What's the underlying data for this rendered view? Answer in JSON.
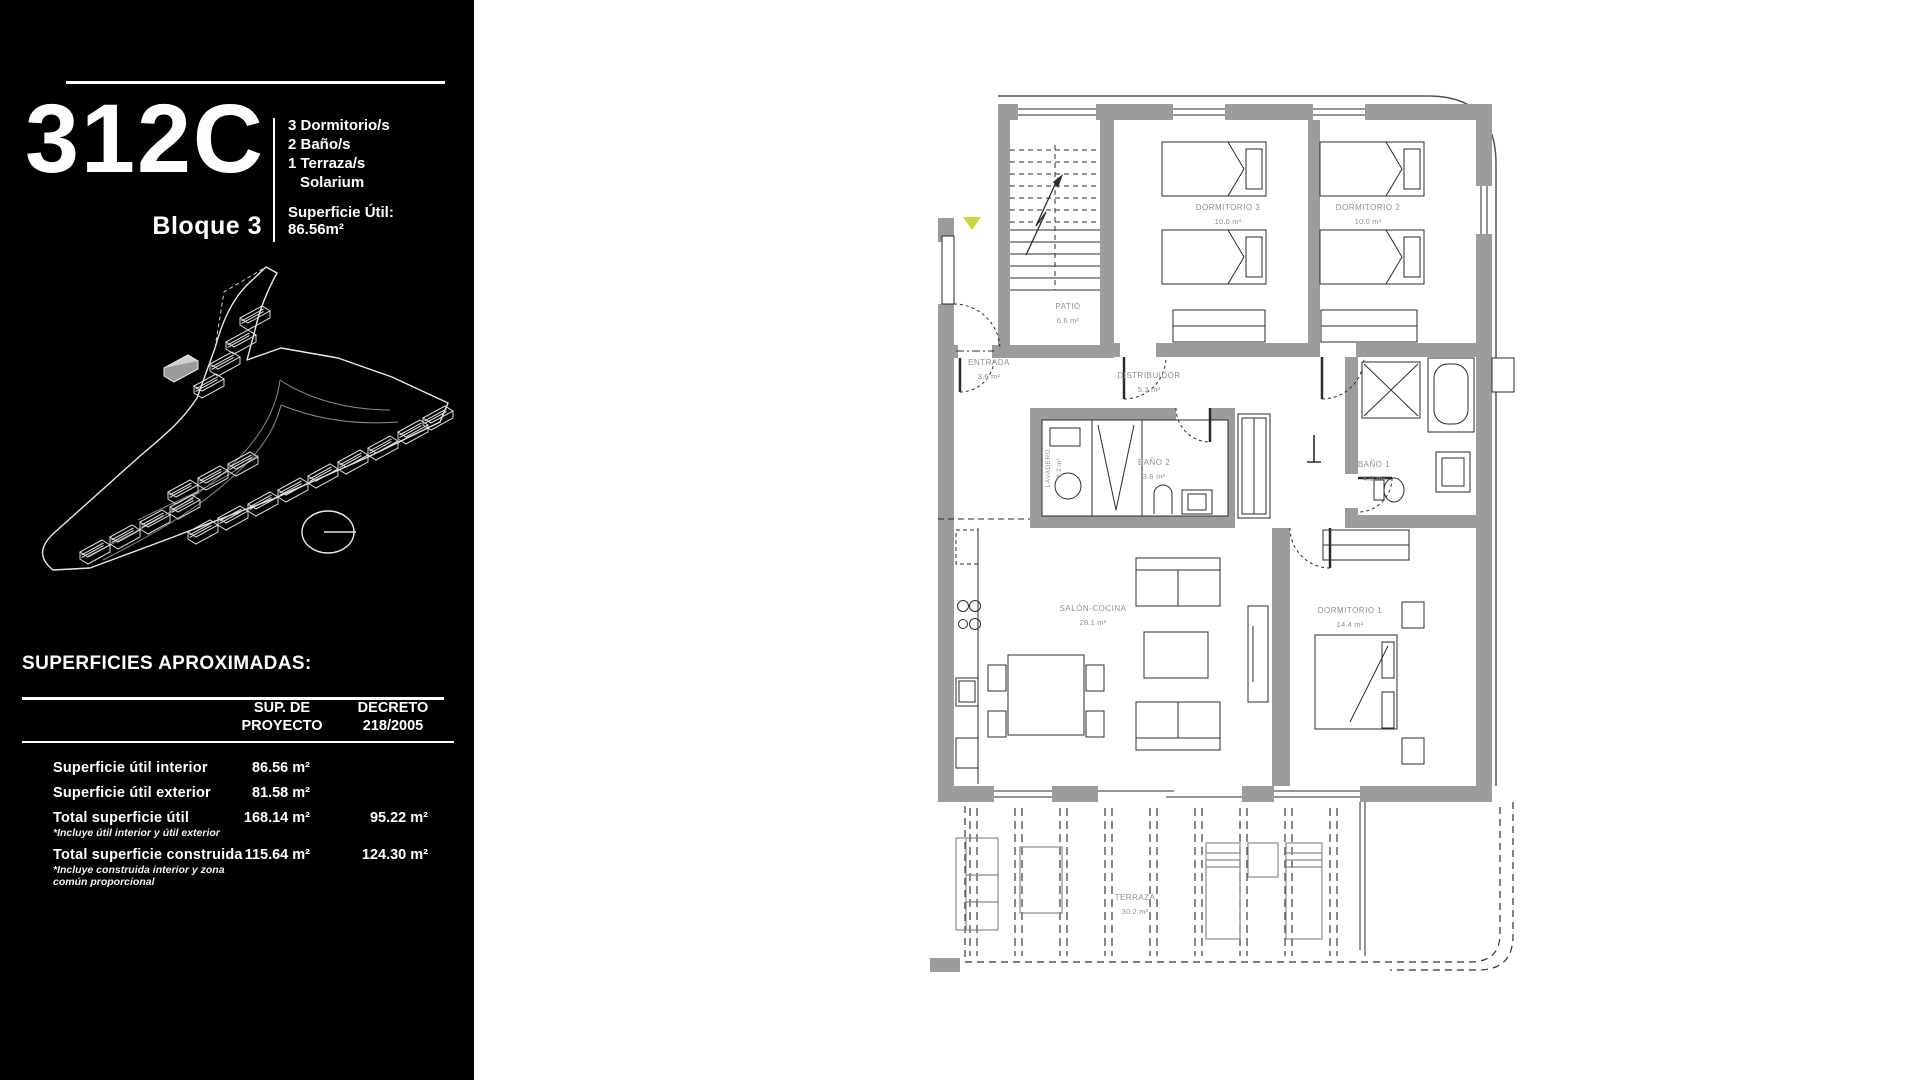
{
  "document": {
    "background": "#ffffff",
    "sidebar_background": "#000000"
  },
  "sidebar": {
    "unit": {
      "code": "312C",
      "block": "Bloque 3"
    },
    "features": [
      "3 Dormitorio/s",
      "2 Baño/s",
      "1 Terraza/s",
      "Solarium"
    ],
    "surface": {
      "label": "Superficie Útil:",
      "value": "86.56m²"
    },
    "site_plan": {
      "description": "aerial-site-plan-drawing",
      "compass": "north-indicator"
    },
    "superficies": {
      "title": "SUPERFICIES APROXIMADAS:",
      "columns": [
        {
          "line1": "SUP. DE",
          "line2": "PROYECTO"
        },
        {
          "line1": "DECRETO",
          "line2": "218/2005"
        }
      ],
      "rows": [
        {
          "label": "Superficie útil interior",
          "note": "",
          "sup": "86.56 m²",
          "decreto": ""
        },
        {
          "label": "Superficie útil exterior",
          "note": "",
          "sup": "81.58 m²",
          "decreto": ""
        },
        {
          "label": "Total superficie útil",
          "note": "*Incluye útil interior y útil exterior",
          "sup": "168.14 m²",
          "decreto": "95.22 m²"
        },
        {
          "label": "Total superficie construida",
          "note": "*Incluye construida interior y zona común proporcional",
          "sup": "115.64 m²",
          "decreto": "124.30 m²"
        }
      ]
    }
  },
  "floor_plan": {
    "marker_color": "#c9d63e",
    "wall_color": "#9c9c9c",
    "rooms": [
      {
        "name": "PATIO",
        "area": "6.6 m²"
      },
      {
        "name": "DORMITORIO 3",
        "area": "10.0 m²"
      },
      {
        "name": "DORMITORIO 2",
        "area": "10.0 m²"
      },
      {
        "name": "ENTRADA",
        "area": "3.6 m²"
      },
      {
        "name": "DISTRIBUIDOR",
        "area": "5.3 m²"
      },
      {
        "name": "LAVADERO",
        "area": "1.2 m²"
      },
      {
        "name": "BAÑO 2",
        "area": "3.6 m²"
      },
      {
        "name": "BAÑO 1",
        "area": "4.0 m²"
      },
      {
        "name": "SALÓN-COCINA",
        "area": "28.1 m²"
      },
      {
        "name": "DORMITORIO 1",
        "area": "14.4 m²"
      },
      {
        "name": "TERRAZA",
        "area": "30.2 m²"
      }
    ]
  }
}
